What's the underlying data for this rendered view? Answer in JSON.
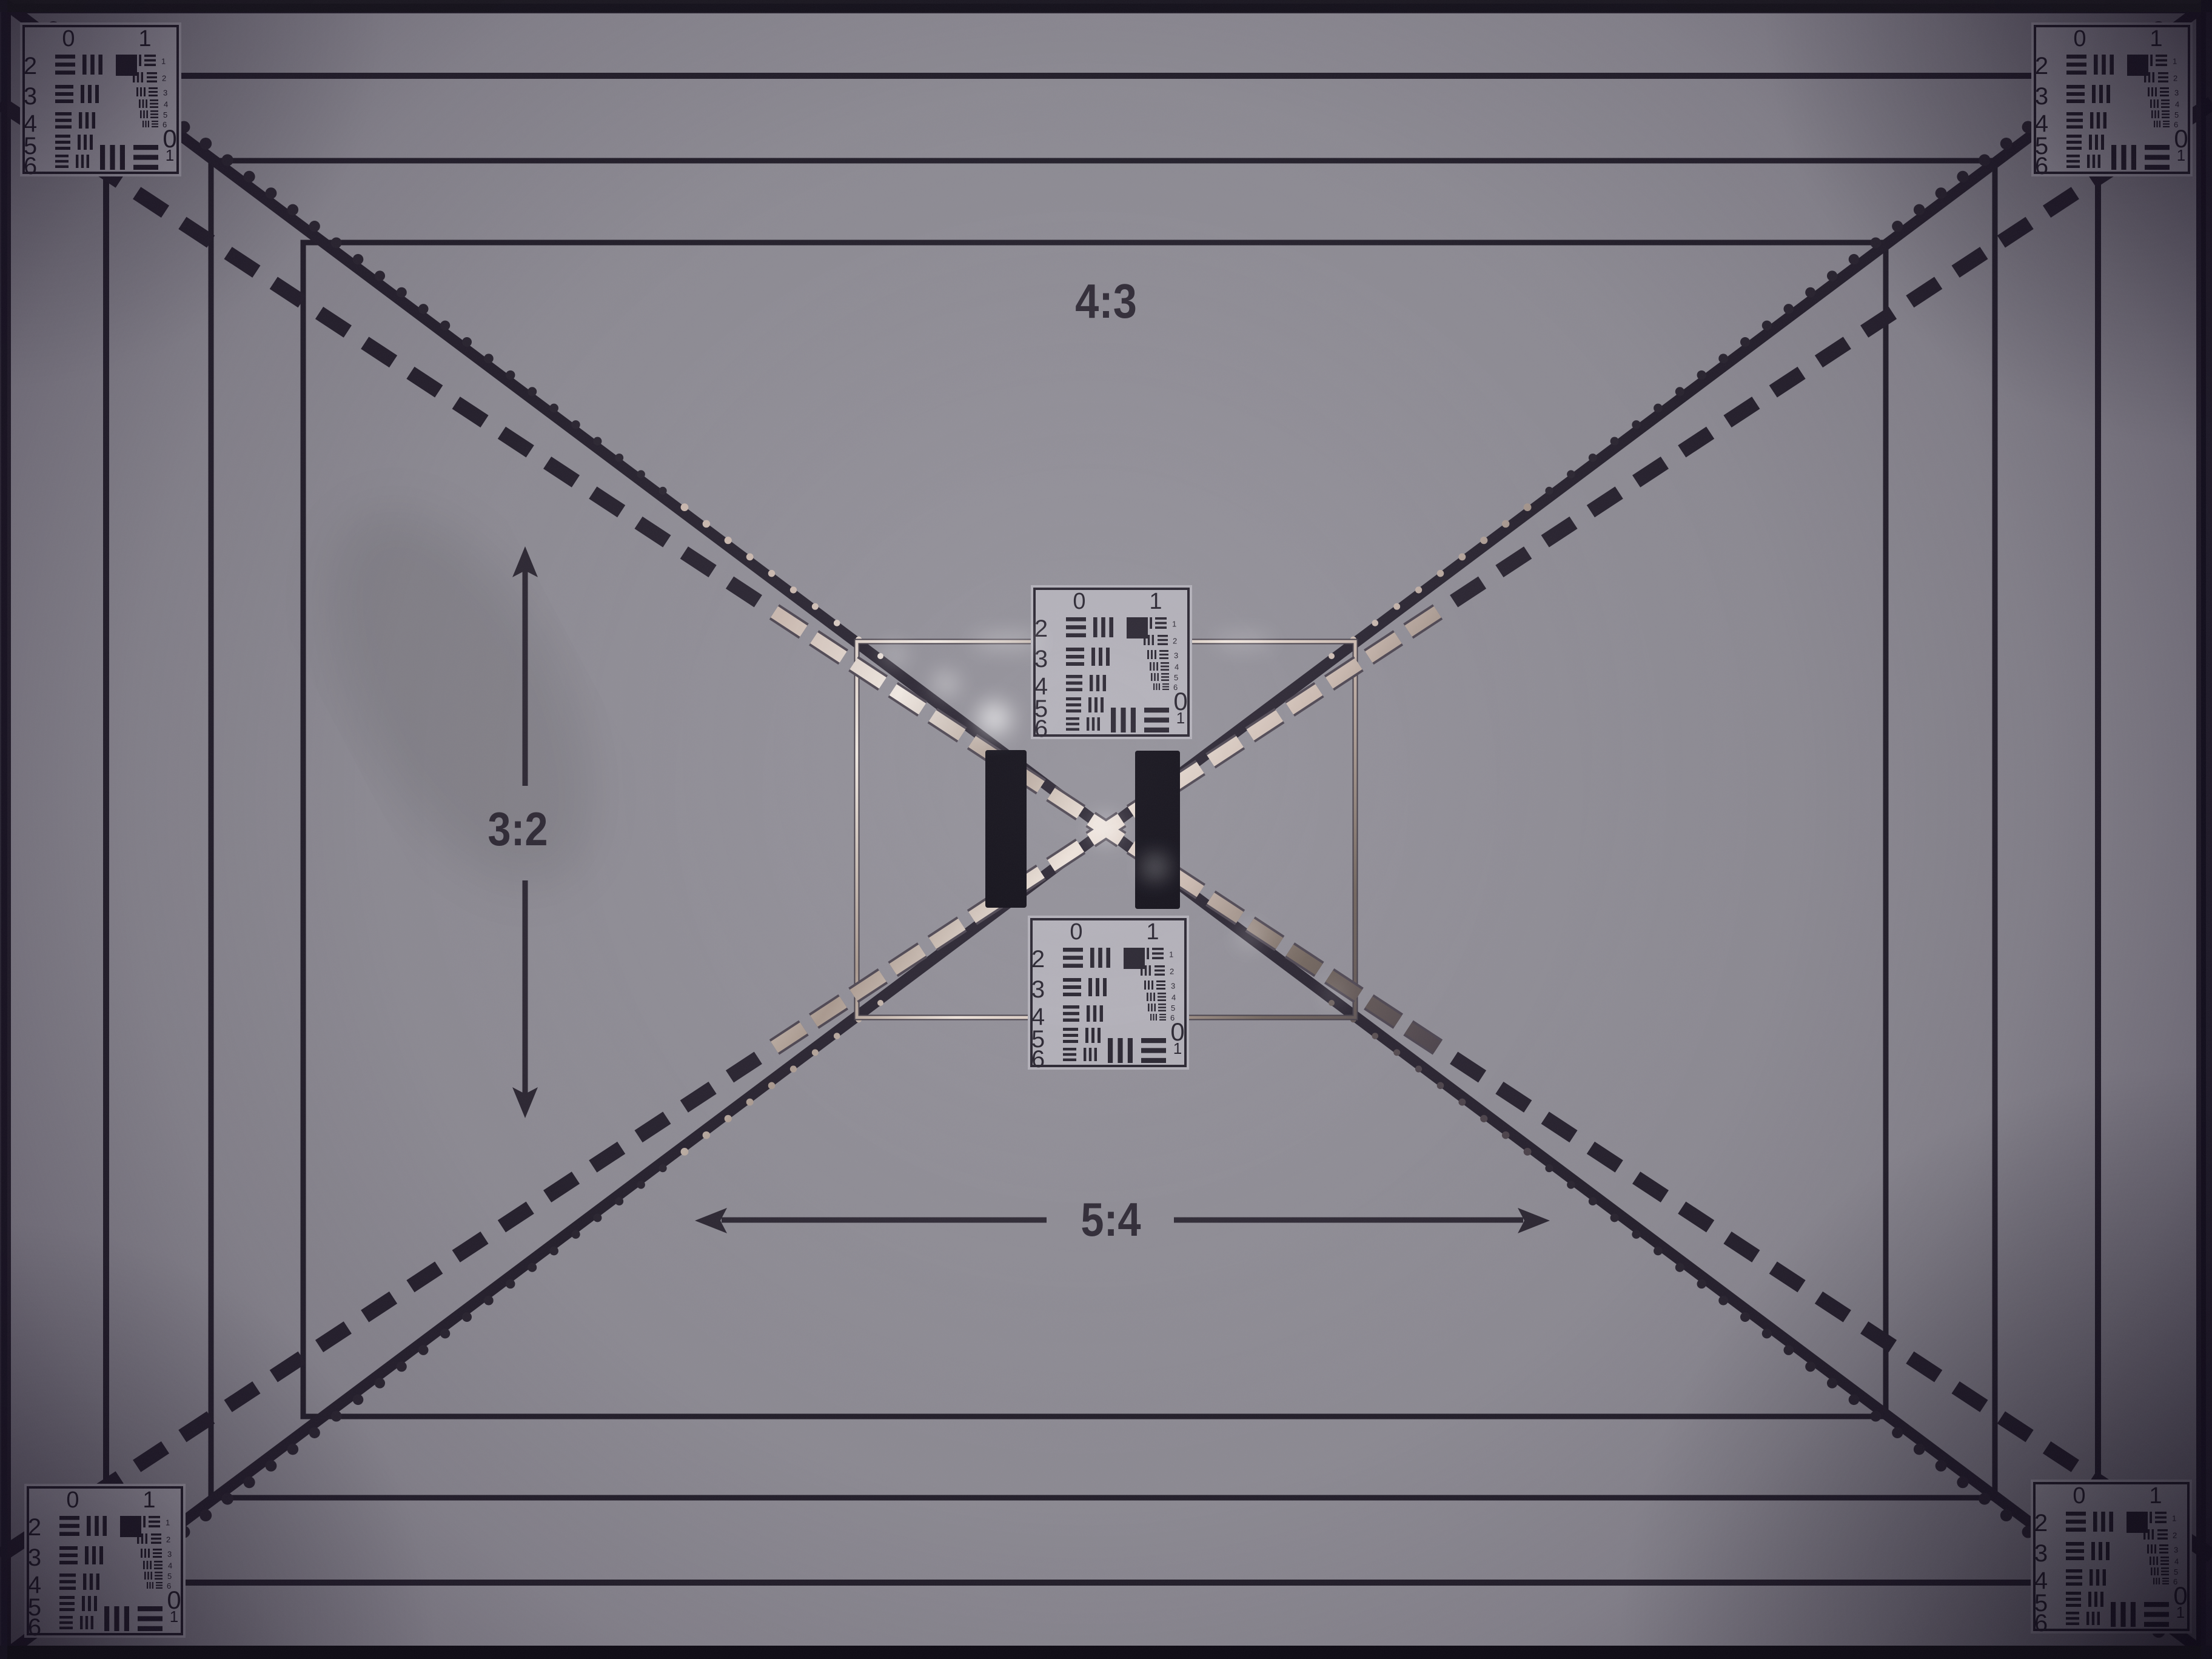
{
  "labels": {
    "aspect_top": "4:3",
    "aspect_left": "3:2",
    "aspect_bottom": "5:4"
  },
  "usaf_target": {
    "group_label_left": "0",
    "group_label_right": "1",
    "row_labels": [
      "2",
      "3",
      "4",
      "5",
      "6"
    ],
    "element_labels": [
      "1",
      "2",
      "3",
      "4",
      "5",
      "6"
    ],
    "corner_group_label": "0",
    "corner_element_label": "1"
  },
  "colors": {
    "paper": "#8f8d95",
    "card": "#b1afb7",
    "ink": "#221e29",
    "label_ink": "#2d2833",
    "bar_black": "#08060f",
    "edge_shadow": "#131019",
    "tape_highlight": "#f2eae2",
    "tape_mid": "#cbb9ae",
    "tape_dark": "#6f6259"
  }
}
